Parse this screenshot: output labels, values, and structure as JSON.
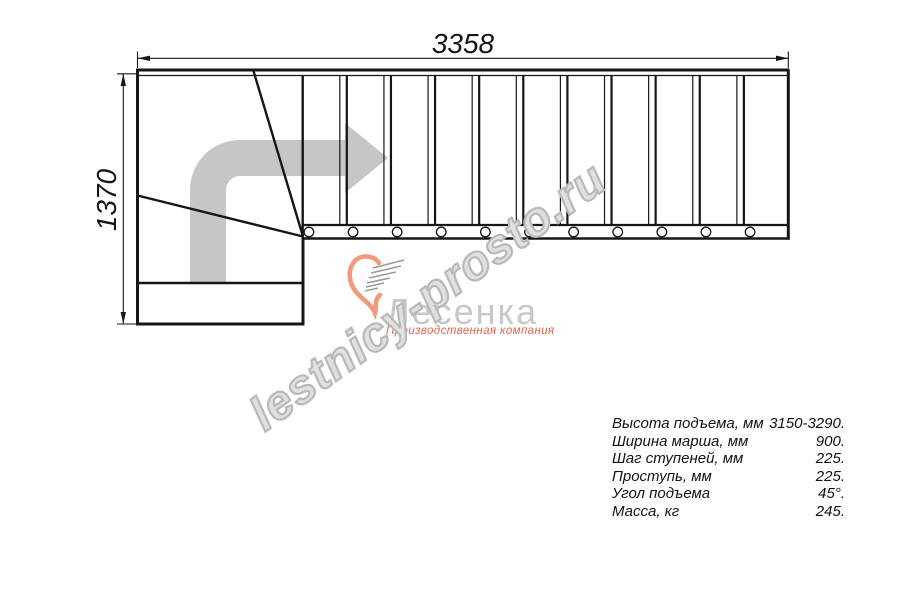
{
  "drawing": {
    "dim_width_label": "3358",
    "dim_height_label": "1370",
    "tread_count": 11,
    "line_color": "#161616",
    "arrow_color": "#c6c6c6"
  },
  "watermark": {
    "text": "lestnicy-prosto.ru",
    "outline_color": "#b9b9b9"
  },
  "logo": {
    "name": "Лесенка",
    "tagline": "Производственная компания",
    "accent_color": "#f29a7e",
    "name_color": "#c8c8c8",
    "tagline_color": "#e5664c"
  },
  "specs": {
    "rows": [
      {
        "label": "Высота подъема, мм",
        "value": "3150-3290."
      },
      {
        "label": "Ширина марша, мм",
        "value": "900."
      },
      {
        "label": "Шаг ступеней, мм",
        "value": "225."
      },
      {
        "label": "Проступь, мм",
        "value": "225."
      },
      {
        "label": "Угол подъема",
        "value": "45°."
      },
      {
        "label": "Масса, кг",
        "value": "245."
      }
    ]
  }
}
